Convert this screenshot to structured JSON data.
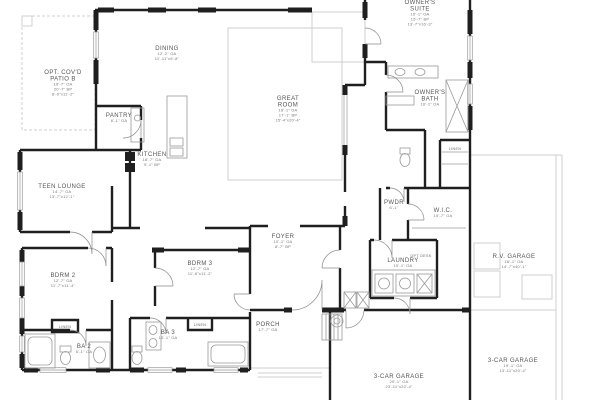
{
  "document": {
    "type": "architectural-floor-plan"
  },
  "colors": {
    "background": "#ffffff",
    "walls": "#1f1f1f",
    "optional_lines": "#cfcfcf",
    "fixture_lines": "#9a9a9a",
    "room_label_text": "#555555",
    "dimension_text": "#777777"
  },
  "floor_plan": {
    "rooms": [
      {
        "id": "opt-covd-patio-b",
        "name_lines": [
          "OPT. COV'D",
          "PATIO B"
        ],
        "dim_lines": [
          "16'-7\" OA",
          "20'-7\" BP",
          "8'-0\"x11'-2\""
        ],
        "x": 63,
        "y": 74
      },
      {
        "id": "dining",
        "name_lines": [
          "DINING"
        ],
        "dim_lines": [
          "12'-2\" OA",
          "11'-11\"x9'-8\""
        ],
        "x": 167,
        "y": 50
      },
      {
        "id": "great-room",
        "name_lines": [
          "GREAT",
          "ROOM"
        ],
        "dim_lines": [
          "18'-1\" OA",
          "17'-1\" BP",
          "15'-4\"x20'-4\""
        ],
        "x": 288,
        "y": 100
      },
      {
        "id": "owners-suite",
        "name_lines": [
          "OWNER'S",
          "SUITE"
        ],
        "dim_lines": [
          "16'-1\" OA",
          "15'-7\" BP",
          "13'-7\"x16'-3\""
        ],
        "x": 420,
        "y": 4
      },
      {
        "id": "owners-bath",
        "name_lines": [
          "OWNER'S",
          "BATH"
        ],
        "dim_lines": [
          "16'-1\" OA"
        ],
        "x": 430,
        "y": 94
      },
      {
        "id": "pantry",
        "name_lines": [
          "PANTRY"
        ],
        "dim_lines": [
          "6'-1\" OA"
        ],
        "x": 119,
        "y": 117
      },
      {
        "id": "kitchen",
        "name_lines": [
          "KITCHEN"
        ],
        "dim_lines": [
          "18'-7\" OA",
          "9'-1\" BP"
        ],
        "x": 152,
        "y": 156
      },
      {
        "id": "teen-lounge",
        "name_lines": [
          "TEEN LOUNGE"
        ],
        "dim_lines": [
          "14'-7\" OA",
          "13'-7\"x12'-1\""
        ],
        "x": 62,
        "y": 188
      },
      {
        "id": "foyer",
        "name_lines": [
          "FOYER"
        ],
        "dim_lines": [
          "10'-1\" OA",
          "8'-7\" BP"
        ],
        "x": 283,
        "y": 238
      },
      {
        "id": "pwdr",
        "name_lines": [
          "PWDR"
        ],
        "dim_lines": [
          "6'-1\""
        ],
        "x": 394,
        "y": 204
      },
      {
        "id": "wic",
        "name_lines": [
          "W.I.C."
        ],
        "dim_lines": [
          "10'-7\" OA"
        ],
        "x": 443,
        "y": 212
      },
      {
        "id": "laundry",
        "name_lines": [
          "LAUNDRY"
        ],
        "dim_lines": [
          "10'-1\" OA"
        ],
        "x": 403,
        "y": 262
      },
      {
        "id": "bdrm-2",
        "name_lines": [
          "BDRM 2"
        ],
        "dim_lines": [
          "12'-7\" OA",
          "11'-7\"x11'-4\""
        ],
        "x": 63,
        "y": 277
      },
      {
        "id": "bdrm-3",
        "name_lines": [
          "BDRM 3"
        ],
        "dim_lines": [
          "12'-7\" OA",
          "11'-6\"x11'-2\""
        ],
        "x": 200,
        "y": 265
      },
      {
        "id": "ba-2",
        "name_lines": [
          "BA 2"
        ],
        "dim_lines": [
          "6'-1\" OA"
        ],
        "x": 84,
        "y": 348
      },
      {
        "id": "ba-3",
        "name_lines": [
          "BA 3"
        ],
        "dim_lines": [
          "10'-1\" OA"
        ],
        "x": 168,
        "y": 334
      },
      {
        "id": "porch",
        "name_lines": [
          "PORCH"
        ],
        "dim_lines": [
          "17'-7\" OA"
        ],
        "x": 268,
        "y": 326
      },
      {
        "id": "rv-garage",
        "name_lines": [
          "R.V. GARAGE"
        ],
        "dim_lines": [
          "16'-1\" OA",
          "14'-7\"x40'-1\""
        ],
        "x": 514,
        "y": 258
      },
      {
        "id": "garage-3-car-main",
        "name_lines": [
          "3-CAR GARAGE"
        ],
        "dim_lines": [
          "20'-1\" OA",
          "23'-11\"x20'-4\""
        ],
        "x": 399,
        "y": 378
      },
      {
        "id": "garage-3-car-right",
        "name_lines": [
          "3-CAR GARAGE"
        ],
        "dim_lines": [
          "19'-1\" OA",
          "13'-11\"x20'-4\""
        ],
        "x": 513,
        "y": 362
      },
      {
        "id": "linen-ba2",
        "name_lines": [
          "LINEN"
        ],
        "dim_lines": [],
        "x": 65,
        "y": 328,
        "small": true
      },
      {
        "id": "linen-ba3",
        "name_lines": [
          "LINEN"
        ],
        "dim_lines": [],
        "x": 200,
        "y": 326,
        "small": true
      },
      {
        "id": "linen-owners",
        "name_lines": [
          "LINEN"
        ],
        "dim_lines": [],
        "x": 455,
        "y": 150,
        "small": true
      },
      {
        "id": "opt-desk",
        "name_lines": [
          "OPT DESK"
        ],
        "dim_lines": [],
        "x": 421,
        "y": 257,
        "small": true
      }
    ]
  }
}
